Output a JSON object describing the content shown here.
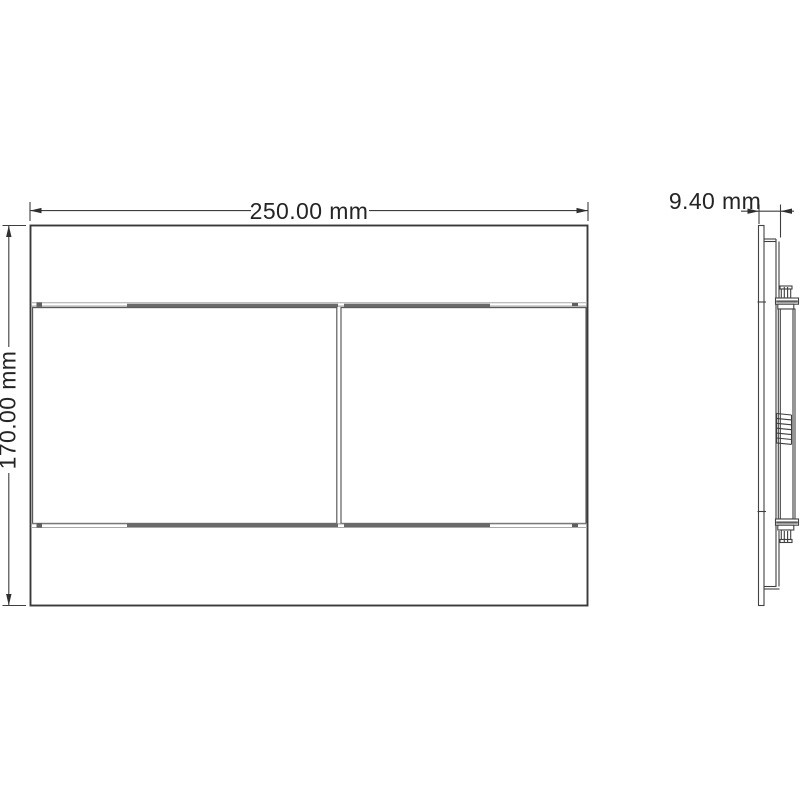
{
  "drawing": {
    "name": "dual-flush-plate-technical-drawing",
    "views": {
      "front": "front view",
      "side": "side view"
    },
    "dimensions": {
      "width": {
        "label": "250.00 mm",
        "value": 250.0,
        "unit": "mm"
      },
      "height": {
        "label": "170.00 mm",
        "value": 170.0,
        "unit": "mm"
      },
      "depth": {
        "label": "9.40 mm",
        "value": 9.4,
        "unit": "mm"
      }
    },
    "colors": {
      "background": "#ffffff",
      "line": "#3e3e3e",
      "seam_shadow": "#696969",
      "dimension_text": "#242424"
    }
  }
}
